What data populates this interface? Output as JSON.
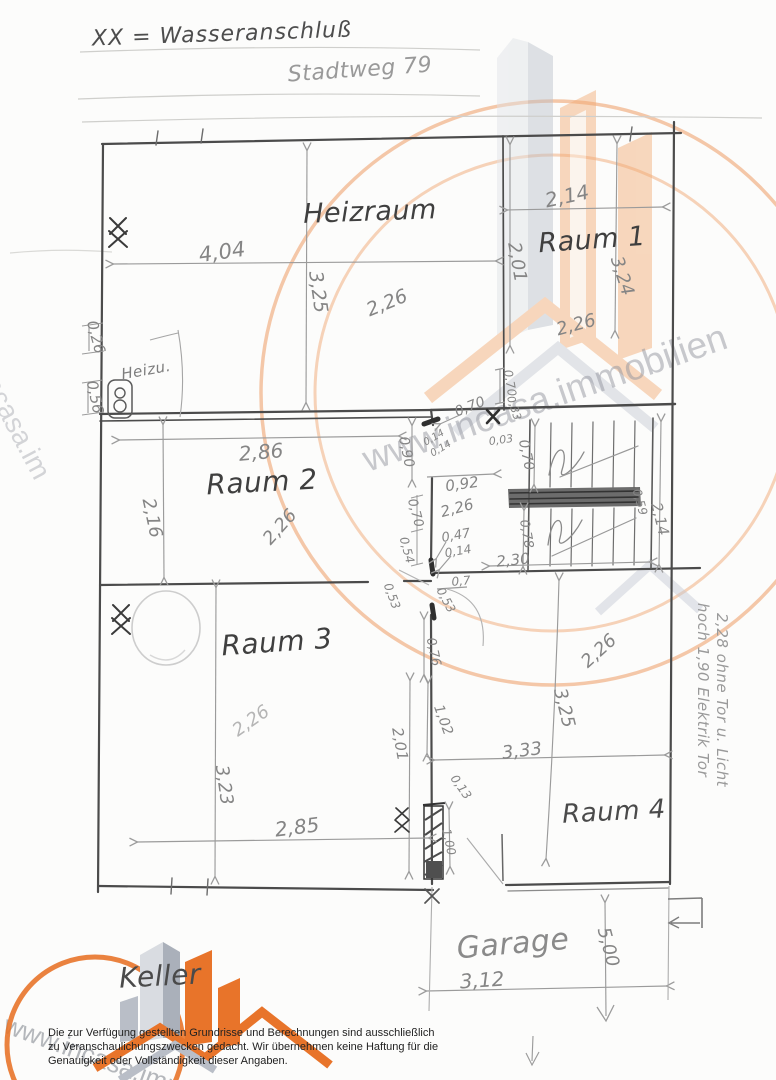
{
  "legend": {
    "symbol_note": "XX = Wasseranschluß"
  },
  "address": "Stadtweg 79",
  "watermark": {
    "url_text": "www.incasa.immobilien",
    "url_text_left": "www.incasa.im",
    "orange": "#e8742a",
    "light_orange": "#f2aa72",
    "gray": "#b9c0ca"
  },
  "room_labels": [
    {
      "name": "heizraum",
      "text": "Heizraum",
      "x": 370,
      "y": 212,
      "rot": -2,
      "size": 27,
      "color": "#3f3f3f"
    },
    {
      "name": "raum-1",
      "text": "Raum 1",
      "x": 592,
      "y": 240,
      "rot": -4,
      "size": 27,
      "color": "#3f3f3f"
    },
    {
      "name": "raum-2",
      "text": "Raum 2",
      "x": 262,
      "y": 482,
      "rot": -3,
      "size": 28,
      "color": "#3f3f3f"
    },
    {
      "name": "raum-3",
      "text": "Raum 3",
      "x": 277,
      "y": 642,
      "rot": -4,
      "size": 28,
      "color": "#3f3f3f"
    },
    {
      "name": "raum-4",
      "text": "Raum 4",
      "x": 614,
      "y": 812,
      "rot": -3,
      "size": 26,
      "color": "#4a4a4a"
    },
    {
      "name": "garage",
      "text": "Garage",
      "x": 513,
      "y": 944,
      "rot": -5,
      "size": 30,
      "color": "#8a8a8a"
    },
    {
      "name": "keller",
      "text": "Keller",
      "x": 160,
      "y": 976,
      "rot": -3,
      "size": 28,
      "color": "#4a4a4a"
    },
    {
      "name": "heizung-klein",
      "text": "Heizu.",
      "x": 146,
      "y": 370,
      "rot": -10,
      "size": 15,
      "color": "#7d7d7d"
    }
  ],
  "measurements": [
    {
      "t": "4,04",
      "x": 222,
      "y": 252,
      "r": -8,
      "s": 21
    },
    {
      "t": "3,25",
      "x": 318,
      "y": 292,
      "r": 82,
      "s": 19
    },
    {
      "t": "2,26",
      "x": 387,
      "y": 303,
      "r": -22,
      "s": 19
    },
    {
      "t": "2,14",
      "x": 567,
      "y": 196,
      "r": -12,
      "s": 20
    },
    {
      "t": "2,01",
      "x": 517,
      "y": 262,
      "r": 80,
      "s": 18
    },
    {
      "t": "3,24",
      "x": 622,
      "y": 276,
      "r": 72,
      "s": 18
    },
    {
      "t": "2,26",
      "x": 576,
      "y": 325,
      "r": -15,
      "s": 18
    },
    {
      "t": "0,26",
      "x": 96,
      "y": 337,
      "r": 75,
      "s": 15
    },
    {
      "t": "0,56",
      "x": 95,
      "y": 397,
      "r": 78,
      "s": 15
    },
    {
      "t": "2,86",
      "x": 261,
      "y": 452,
      "r": -5,
      "s": 20
    },
    {
      "t": "2,16",
      "x": 152,
      "y": 518,
      "r": 78,
      "s": 18
    },
    {
      "t": "2,26",
      "x": 280,
      "y": 527,
      "r": -48,
      "s": 18
    },
    {
      "t": "0,90",
      "x": 406,
      "y": 452,
      "r": 78,
      "s": 14
    },
    {
      "t": "0,70",
      "x": 470,
      "y": 407,
      "r": -22,
      "s": 14
    },
    {
      "t": "0,70",
      "x": 510,
      "y": 383,
      "r": 80,
      "s": 12
    },
    {
      "t": "0,33",
      "x": 514,
      "y": 408,
      "r": 72,
      "s": 11
    },
    {
      "t": "0,03",
      "x": 501,
      "y": 440,
      "r": -8,
      "s": 11
    },
    {
      "t": "0,14",
      "x": 434,
      "y": 438,
      "r": -30,
      "s": 10
    },
    {
      "t": "0,14",
      "x": 441,
      "y": 449,
      "r": -30,
      "s": 10
    },
    {
      "t": "0,92",
      "x": 462,
      "y": 484,
      "r": -8,
      "s": 15
    },
    {
      "t": "2,26",
      "x": 457,
      "y": 508,
      "r": -15,
      "s": 15
    },
    {
      "t": "0,70",
      "x": 526,
      "y": 455,
      "r": 78,
      "s": 14
    },
    {
      "t": "0,70",
      "x": 415,
      "y": 513,
      "r": 75,
      "s": 13
    },
    {
      "t": "0,54",
      "x": 407,
      "y": 550,
      "r": 75,
      "s": 12
    },
    {
      "t": "0,47",
      "x": 456,
      "y": 536,
      "r": -10,
      "s": 13
    },
    {
      "t": "0,14",
      "x": 458,
      "y": 551,
      "r": -10,
      "s": 12
    },
    {
      "t": "2,30",
      "x": 513,
      "y": 560,
      "r": -6,
      "s": 15
    },
    {
      "t": "0,78",
      "x": 526,
      "y": 534,
      "r": 80,
      "s": 13
    },
    {
      "t": "0,59",
      "x": 640,
      "y": 502,
      "r": 75,
      "s": 12
    },
    {
      "t": "2,14",
      "x": 660,
      "y": 519,
      "r": 76,
      "s": 15
    },
    {
      "t": "0,7",
      "x": 461,
      "y": 581,
      "r": -5,
      "s": 12
    },
    {
      "t": "0,53",
      "x": 392,
      "y": 596,
      "r": 70,
      "s": 12
    },
    {
      "t": "0,53",
      "x": 446,
      "y": 600,
      "r": 62,
      "s": 12
    },
    {
      "t": "0,76",
      "x": 433,
      "y": 652,
      "r": 78,
      "s": 13
    },
    {
      "t": "2,26",
      "x": 599,
      "y": 651,
      "r": -42,
      "s": 18
    },
    {
      "t": "3,25",
      "x": 564,
      "y": 708,
      "r": 76,
      "s": 18
    },
    {
      "t": "1,02",
      "x": 443,
      "y": 720,
      "r": 70,
      "s": 14
    },
    {
      "t": "3,33",
      "x": 522,
      "y": 751,
      "r": -7,
      "s": 18
    },
    {
      "t": "2,01",
      "x": 400,
      "y": 744,
      "r": 80,
      "s": 15
    },
    {
      "t": "3,23",
      "x": 224,
      "y": 785,
      "r": 82,
      "s": 18
    },
    {
      "t": "2,26",
      "x": 251,
      "y": 721,
      "r": -35,
      "s": 18,
      "c": "#b5b5b5"
    },
    {
      "t": "2,85",
      "x": 297,
      "y": 827,
      "r": -7,
      "s": 20
    },
    {
      "t": "0,13",
      "x": 461,
      "y": 787,
      "r": 55,
      "s": 12
    },
    {
      "t": "1,00",
      "x": 449,
      "y": 842,
      "r": 78,
      "s": 12
    },
    {
      "t": "3,12",
      "x": 482,
      "y": 980,
      "r": -4,
      "s": 20
    },
    {
      "t": "5,00",
      "x": 608,
      "y": 947,
      "r": 75,
      "s": 18
    }
  ],
  "side_note": {
    "line1": "hoch 1,90 Elektrik Tor",
    "line2": "2,28 ohne Tor u. Licht"
  },
  "disclaimer": [
    "Die zur Verfügung gestellten Grundrisse und Berechnungen sind ausschließlich",
    "zu Veranschaulichungszwecken gedacht. Wir übernehmen keine Haftung für die",
    "Genauigkeit oder Vollständigkeit dieser Angaben."
  ]
}
